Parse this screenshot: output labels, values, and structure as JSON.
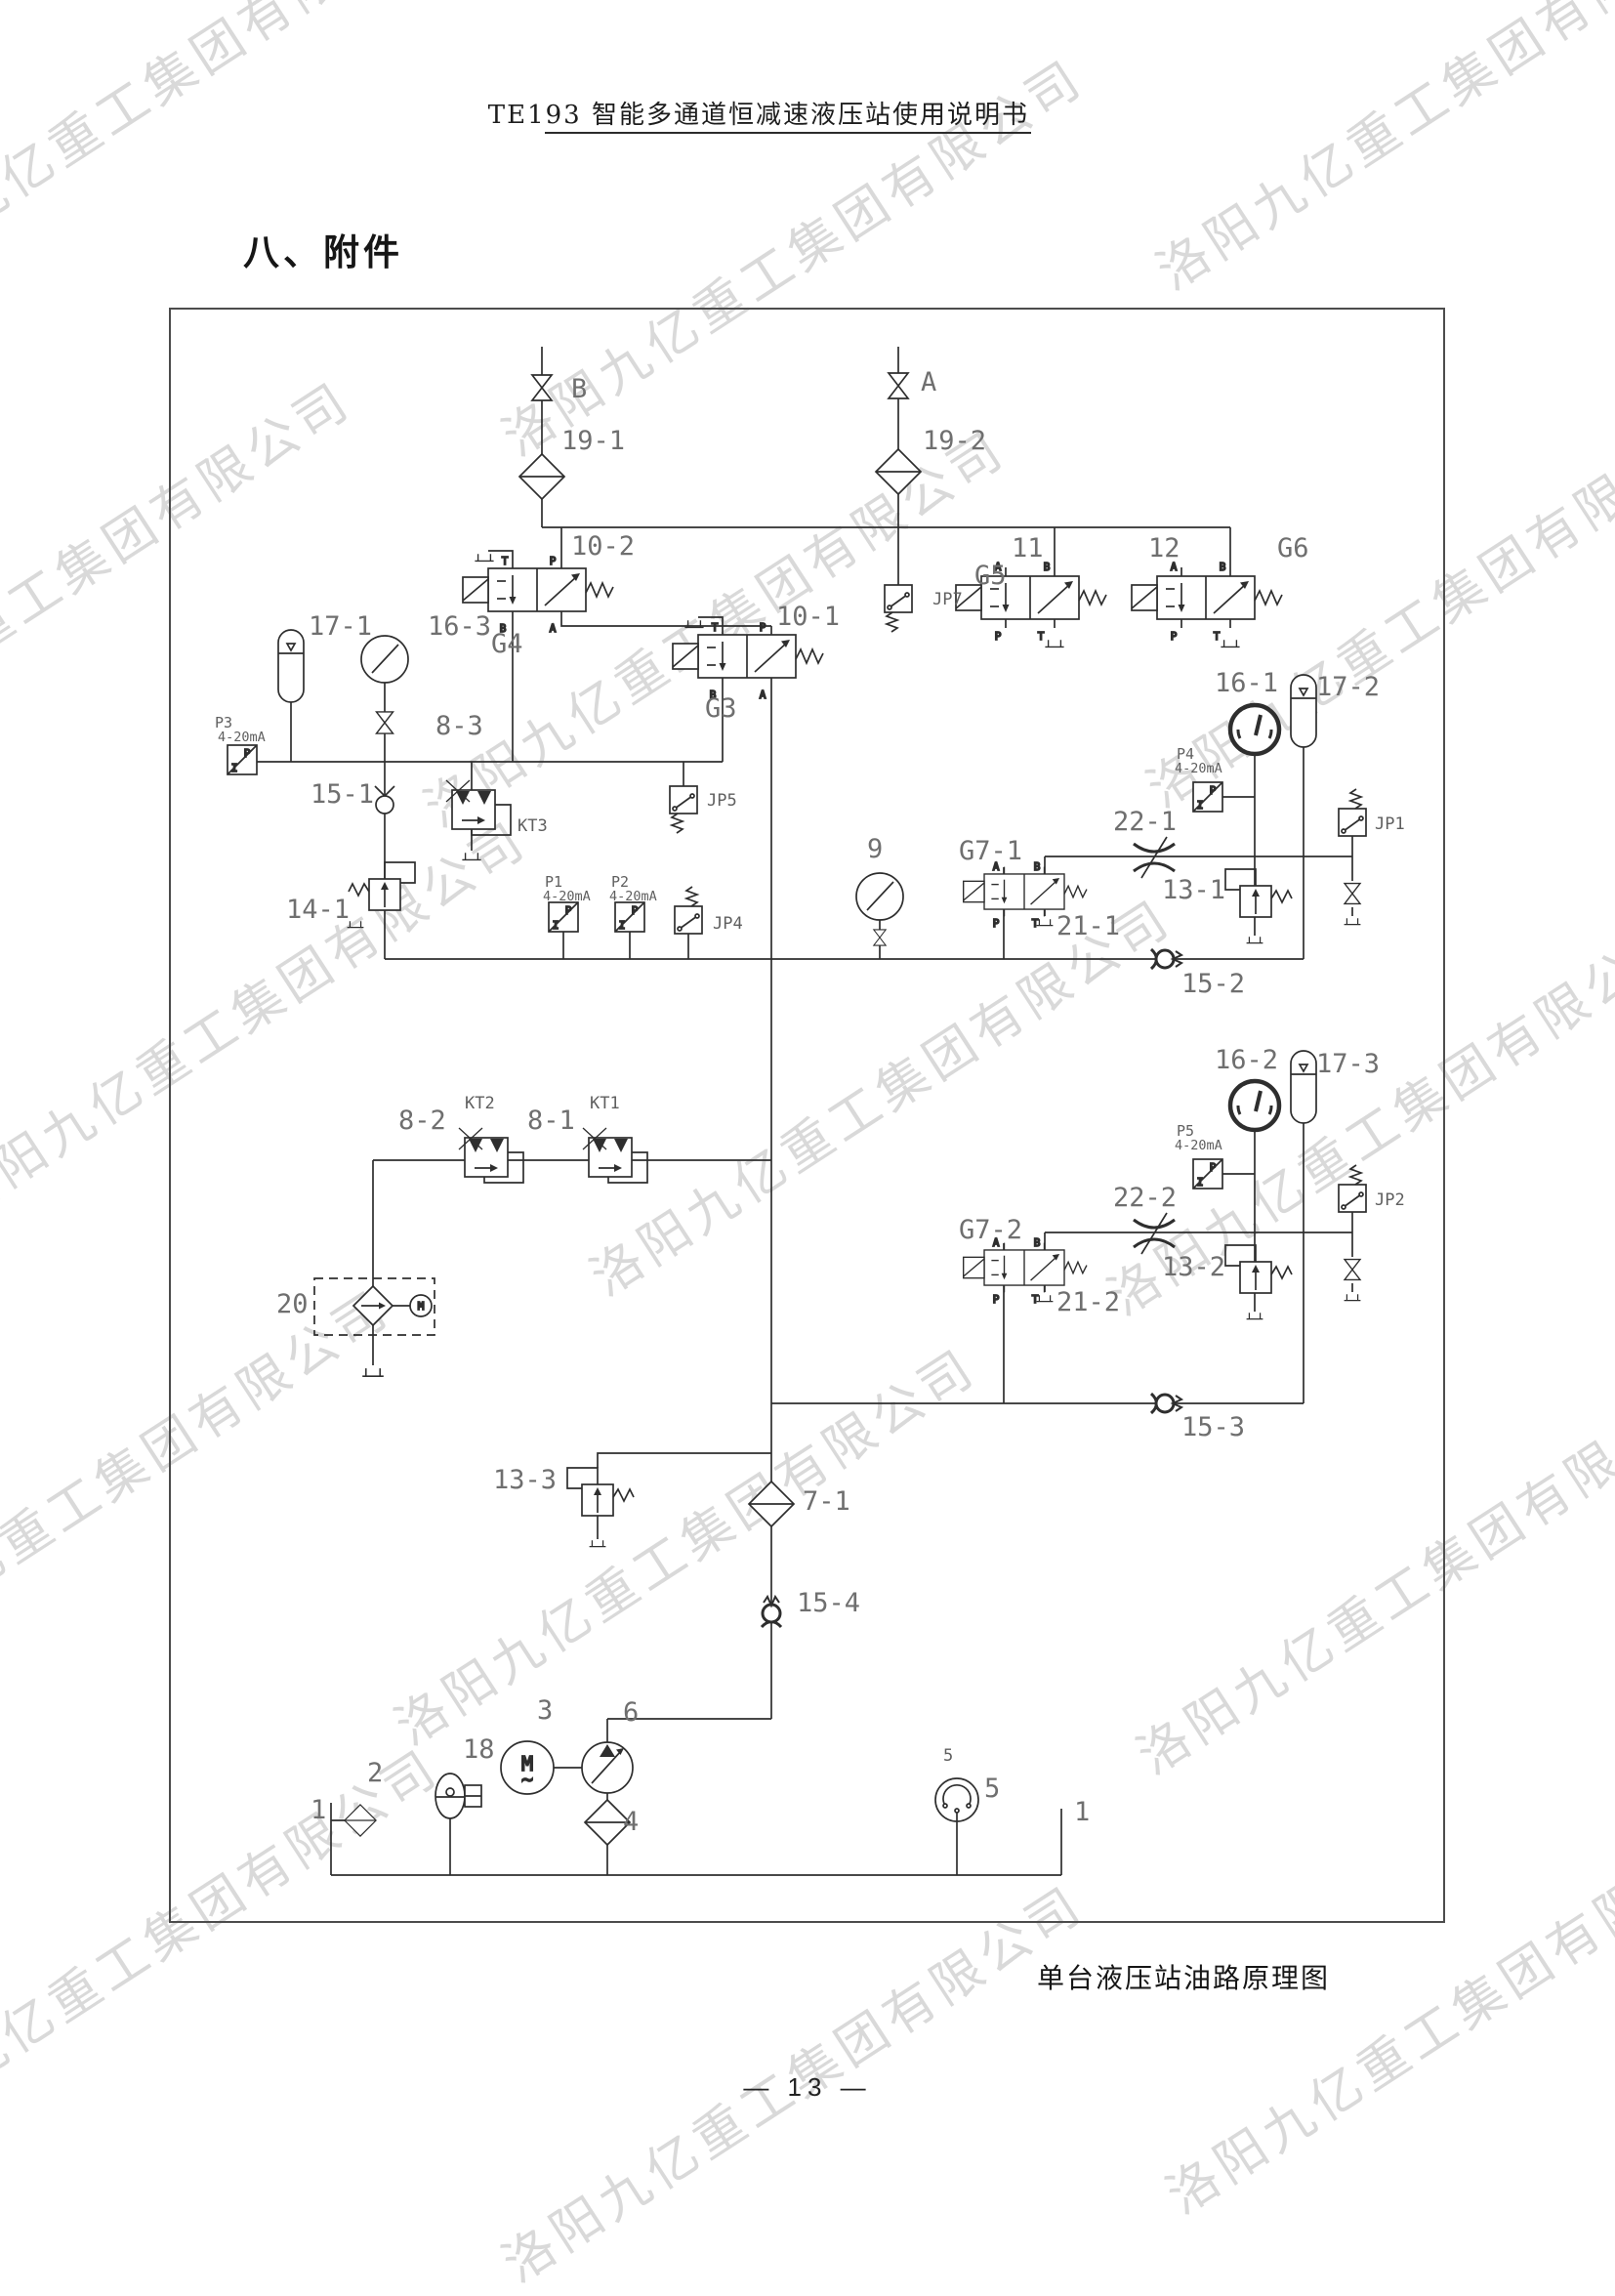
{
  "header": {
    "title": "TE193 智能多通道恒减速液压站使用说明书"
  },
  "section_title": "八、附件",
  "caption": "单台液压站油路原理图",
  "page_number": "— 13 —",
  "watermark": {
    "text": "洛阳九亿重工集团有限公司"
  },
  "sym": {
    "A": "A",
    "B": "B",
    "P": "P",
    "T": "T",
    "M": "M",
    "tilde": "~",
    "I": "I"
  },
  "diagram": {
    "labels": {
      "port_b": "B",
      "n19_1": "19-1",
      "port_a": "A",
      "n19_2": "19-2",
      "n10_2": "10-2",
      "g4": "G4",
      "n10_1": "10-1",
      "g3": "G3",
      "jp7": "JP7",
      "n11": "11",
      "g5": "G5",
      "n12": "12",
      "g6": "G6",
      "n17_1": "17-1",
      "n16_3": "16-3",
      "p3": "P3",
      "p3_range": "4-20mA",
      "n8_3": "8-3",
      "n15_1": "15-1",
      "kt3": "KT3",
      "n14_1": "14-1",
      "p1": "P1",
      "p1_range": "4-20mA",
      "p2": "P2",
      "p2_range": "4-20mA",
      "jp4": "JP4",
      "jp5": "JP5",
      "n9": "9",
      "g7_1": "G7-1",
      "n21_1": "21-1",
      "n22_1": "22-1",
      "n13_1": "13-1",
      "n16_1": "16-1",
      "n17_2": "17-2",
      "p4": "P4",
      "p4_range": "4-20mA",
      "jp1": "JP1",
      "n15_2": "15-2",
      "n16_2": "16-2",
      "n17_3": "17-3",
      "p5": "P5",
      "p5_range": "4-20mA",
      "jp2": "JP2",
      "n22_2": "22-2",
      "g7_2": "G7-2",
      "n13_2": "13-2",
      "n21_2": "21-2",
      "n15_3": "15-3",
      "n8_2": "8-2",
      "kt2": "KT2",
      "n8_1": "8-1",
      "kt1": "KT1",
      "n20": "20",
      "n13_3": "13-3",
      "n7_1": "7-1",
      "n15_4": "15-4",
      "n3": "3",
      "n6": "6",
      "n18": "18",
      "n2": "2",
      "n1_left": "1",
      "n4": "4",
      "n5_small": "5",
      "n5": "5",
      "n1_right": "1"
    }
  }
}
